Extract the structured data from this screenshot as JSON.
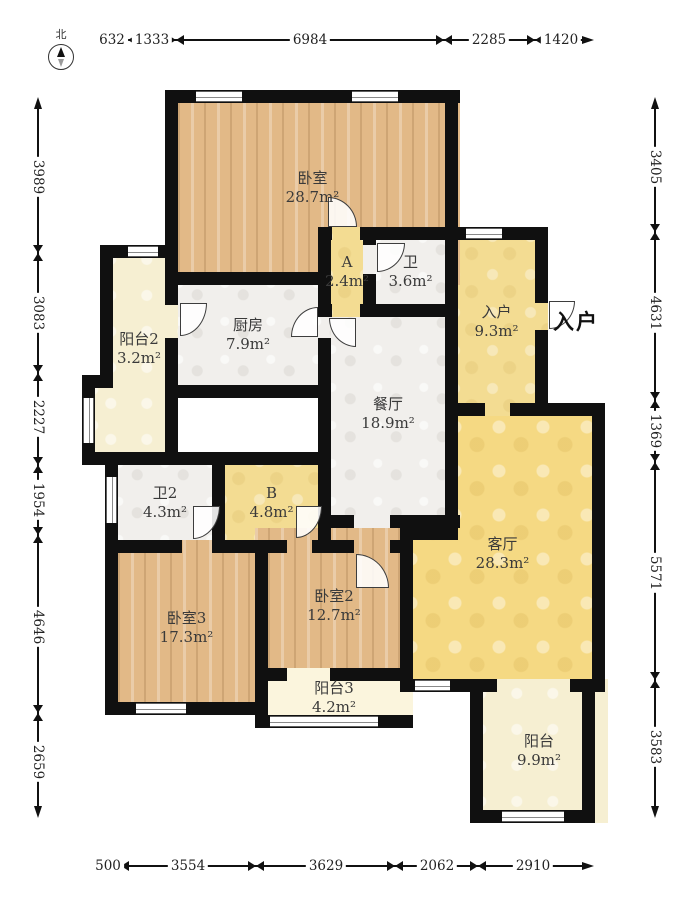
{
  "compass": {
    "label": "北"
  },
  "entry_callout": "入户",
  "rooms": [
    {
      "label": "卧室",
      "area": "28.7m²"
    },
    {
      "label": "A",
      "area": "2.4m²"
    },
    {
      "label": "卫",
      "area": "3.6m²"
    },
    {
      "label": "入户",
      "area": "9.3m²"
    },
    {
      "label": "厨房",
      "area": "7.9m²"
    },
    {
      "label": "阳台2",
      "area": "3.2m²"
    },
    {
      "label": "餐厅",
      "area": "18.9m²"
    },
    {
      "label": "卫2",
      "area": "4.3m²"
    },
    {
      "label": "B",
      "area": "4.8m²"
    },
    {
      "label": "客厅",
      "area": "28.3m²"
    },
    {
      "label": "卧室3",
      "area": "17.3m²"
    },
    {
      "label": "卧室2",
      "area": "12.7m²"
    },
    {
      "label": "阳台3",
      "area": "4.2m²"
    },
    {
      "label": "阳台",
      "area": "9.9m²"
    }
  ],
  "dimensions": {
    "top": [
      "632",
      "1333",
      "6984",
      "2285",
      "1420"
    ],
    "left": [
      "3989",
      "3083",
      "2227",
      "1954",
      "4646",
      "2659"
    ],
    "right": [
      "3405",
      "4631",
      "1369",
      "5571",
      "3583"
    ],
    "bottom": [
      "500",
      "3554",
      "3629",
      "2062",
      "2910"
    ]
  },
  "colors": {
    "wall": "#101010",
    "wood": "#e2b987",
    "marble": "#f1efec",
    "yellow": "#f3dc92",
    "living_yellow": "#f5d983",
    "cream": "#f6efd2",
    "pale_cream": "#fbf5dd"
  }
}
